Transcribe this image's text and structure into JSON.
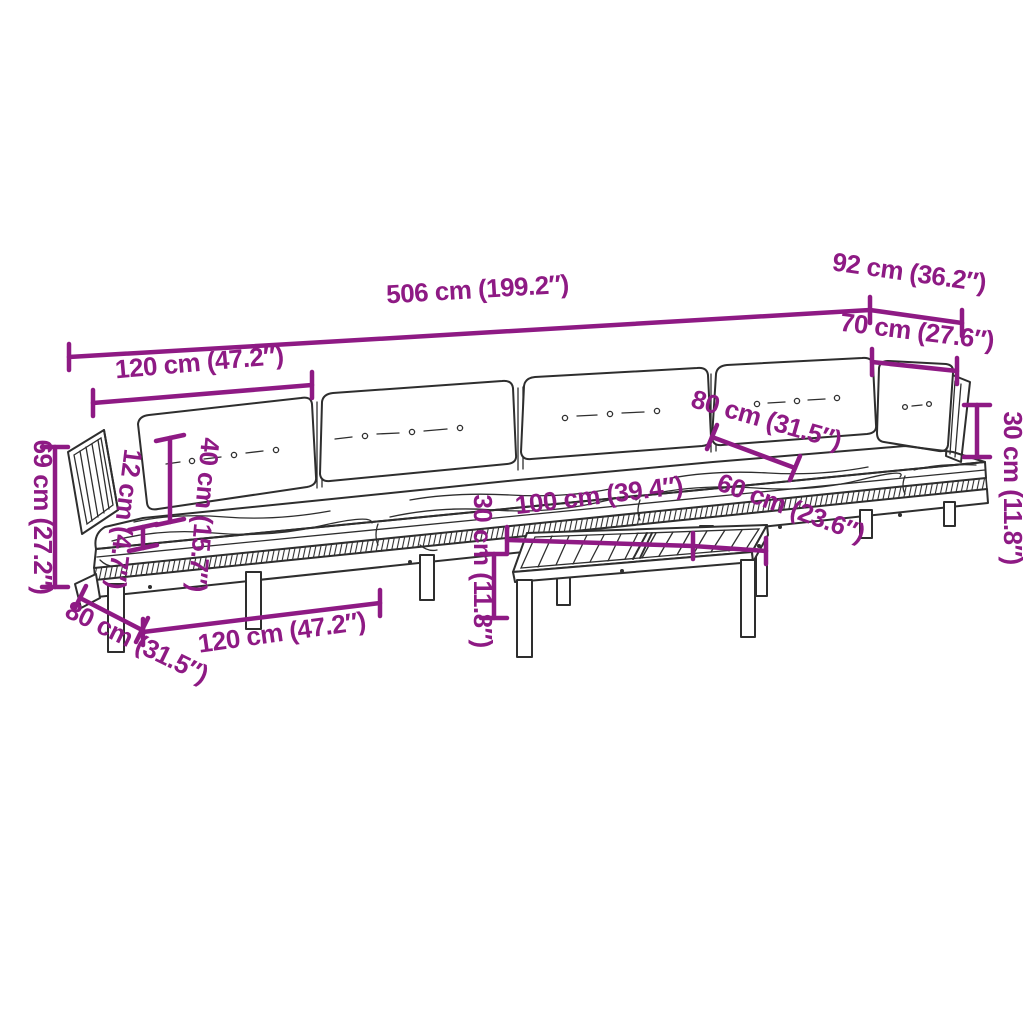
{
  "diagram_type": "furniture-dimension-diagram",
  "product": "pallet-garden-sofa-set-with-table",
  "colors": {
    "dimension_accent": "#8e1a84",
    "line_art": "#2e2e2e",
    "background": "#ffffff"
  },
  "dimensions": {
    "total_width": "506 cm (199.2″)",
    "corner_total_depth": "92 cm (36.2″)",
    "corner_seat_width": "70 cm (27.6″)",
    "side_cushion_height": "30 cm (11.8″)",
    "module_width_back": "120 cm (47.2″)",
    "total_height": "69 cm (27.2″)",
    "seat_cushion_thickness": "12 cm (4.7″)",
    "back_cushion_height": "40 cm (15.7″)",
    "module_depth": "80 cm (31.5″)",
    "module_width_front": "120 cm (47.2″)",
    "seat_depth_between_cushions": "80 cm (31.5″)",
    "table_length": "100 cm (39.4″)",
    "table_depth": "60 cm (23.6″)",
    "table_height": "30 cm (11.8″)"
  }
}
